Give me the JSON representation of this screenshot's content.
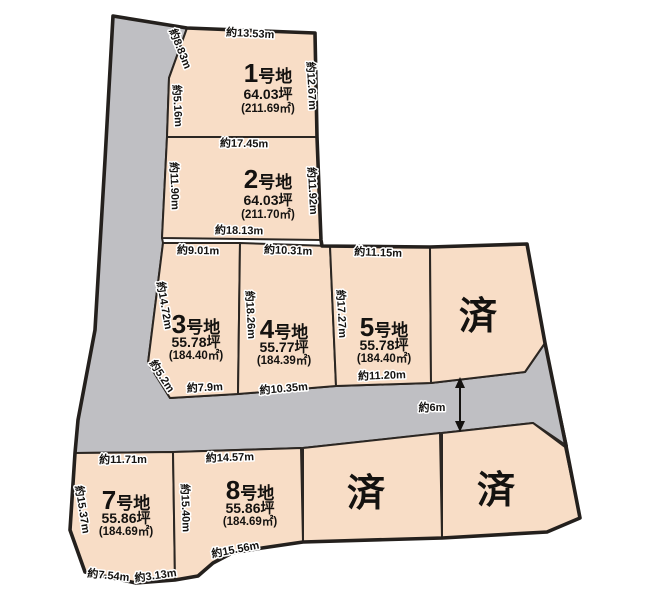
{
  "map": {
    "sold_label": "済",
    "road_width_label": "約6m"
  },
  "lots": [
    {
      "number": "1",
      "suffix": "号地",
      "tsubo": "64.03坪",
      "sqm": "(211.69㎡)"
    },
    {
      "number": "2",
      "suffix": "号地",
      "tsubo": "64.03坪",
      "sqm": "(211.70㎡)"
    },
    {
      "number": "3",
      "suffix": "号地",
      "tsubo": "55.78坪",
      "sqm": "(184.40㎡)"
    },
    {
      "number": "4",
      "suffix": "号地",
      "tsubo": "55.77坪",
      "sqm": "(184.39㎡)"
    },
    {
      "number": "5",
      "suffix": "号地",
      "tsubo": "55.78坪",
      "sqm": "(184.40㎡)"
    },
    {
      "number": "7",
      "suffix": "号地",
      "tsubo": "55.86坪",
      "sqm": "(184.69㎡)"
    },
    {
      "number": "8",
      "suffix": "号地",
      "tsubo": "55.86坪",
      "sqm": "(184.69㎡)"
    }
  ],
  "sold_lots": [
    {
      "label": "済"
    },
    {
      "label": "済"
    },
    {
      "label": "済"
    }
  ],
  "dimensions": {
    "lot1_top": "約13.53m",
    "lot1_left_upper": "約8.83m",
    "lot1_left_lower": "約5.16m",
    "lot1_right": "約12.67m",
    "lot2_top": "約17.45m",
    "lot2_left": "約11.90m",
    "lot2_right": "約11.92m",
    "lot2_bottom": "約18.13m",
    "lot3_top": "約9.01m",
    "lot3_left": "約14.72m",
    "lot3_chamfer": "約5.2m",
    "lot3_bottom": "約7.9m",
    "lot4_top": "約10.31m",
    "lot34_side": "約18.26m",
    "lot4_bottom": "約10.35m",
    "lot5_top": "約11.15m",
    "lot45_side": "約17.27m",
    "lot5_bottom": "約11.20m",
    "road_width": "約6m",
    "lot7_top": "約11.71m",
    "lot7_left": "約15.37m",
    "lot78_side": "約15.40m",
    "lot7_bottom_left": "約7.54m",
    "lot7_bottom_right": "約3.13m",
    "lot8_top": "約14.57m",
    "lot8_bottom": "約15.56m"
  },
  "colors": {
    "lot_fill": "#f8ddc6",
    "road_fill": "#bfbfc3",
    "outline": "#24201d",
    "background": "#ffffff"
  }
}
